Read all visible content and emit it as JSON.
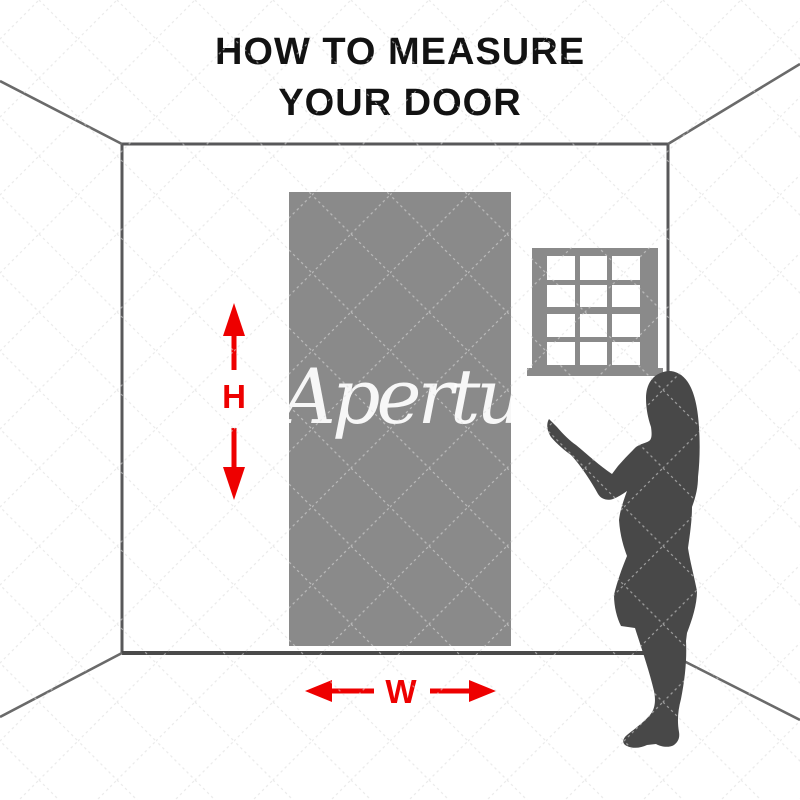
{
  "title": {
    "line1": "HOW TO MEASURE",
    "line2": "YOUR DOOR"
  },
  "watermark": {
    "text": "Aperture"
  },
  "labels": {
    "height": "H",
    "width": "W"
  },
  "window": {
    "columns": 3,
    "rows": 4
  },
  "colors": {
    "background": "#ffffff",
    "title_color": "#121212",
    "arrow_red": "#ee0000",
    "door_gray": "#8a8a8a",
    "window_gray": "#8a8a8a",
    "silhouette_gray": "#484848",
    "wall_line_gray": "#58585a",
    "pattern_line": "#dcdcdc"
  }
}
